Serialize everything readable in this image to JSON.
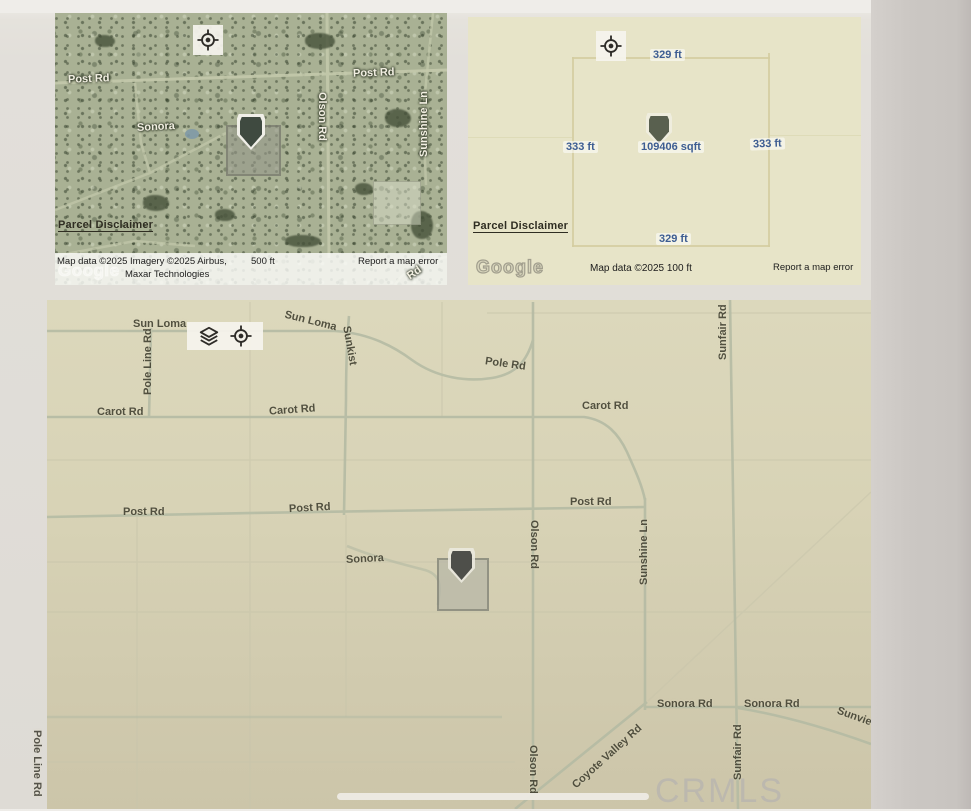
{
  "page": {
    "watermark": "CRMLS"
  },
  "icons": {
    "crosshair": "my-location-target",
    "layers": "map-layers"
  },
  "satellite_map": {
    "roads": {
      "post_rd_left": "Post Rd",
      "post_rd_right": "Post Rd",
      "sonora": "Sonora",
      "olson_rd": "Olson Rd",
      "sunshine_ln": "Sunshine Ln",
      "clipped_rd": "Rd"
    },
    "parcel_disclaimer": "Parcel Disclaimer",
    "google_watermark": "Google",
    "attribution_line1": "Map data ©2025 Imagery ©2025 Airbus,",
    "attribution_line2": "Maxar Technologies",
    "scale_label": "500 ft",
    "report_error": "Report a map error"
  },
  "parcel_map": {
    "dim_top": "329 ft",
    "dim_left": "333 ft",
    "dim_right": "333 ft",
    "dim_bottom": "329 ft",
    "area": "109406 sqft",
    "parcel_disclaimer": "Parcel Disclaimer",
    "google_watermark": "Google",
    "attribution": "Map data ©2025  100 ft",
    "report_error": "Report a map error"
  },
  "road_map": {
    "sun_loma": "Sun Loma",
    "pole_line_rd": "Pole Line Rd",
    "sunkist": "Sunkist",
    "pole_rd": "Pole Rd",
    "carot_rd": "Carot Rd",
    "post_rd": "Post Rd",
    "sonora": "Sonora",
    "olson_rd": "Olson Rd",
    "sunshine_ln": "Sunshine Ln",
    "sunfair_rd": "Sunfair Rd",
    "sonora_rd": "Sonora Rd",
    "coyote_valley_rd": "Coyote Valley Rd",
    "sunview": "Sunview"
  },
  "colors": {
    "dimension_text": "#3d5d92",
    "satellite_base": "#a9b194",
    "parcel_map_bg": "#e7e4c8",
    "road_map_bg": "#d8d3b6",
    "paper": "#e2dfda",
    "watermark_gray": "#bcb8ae"
  }
}
